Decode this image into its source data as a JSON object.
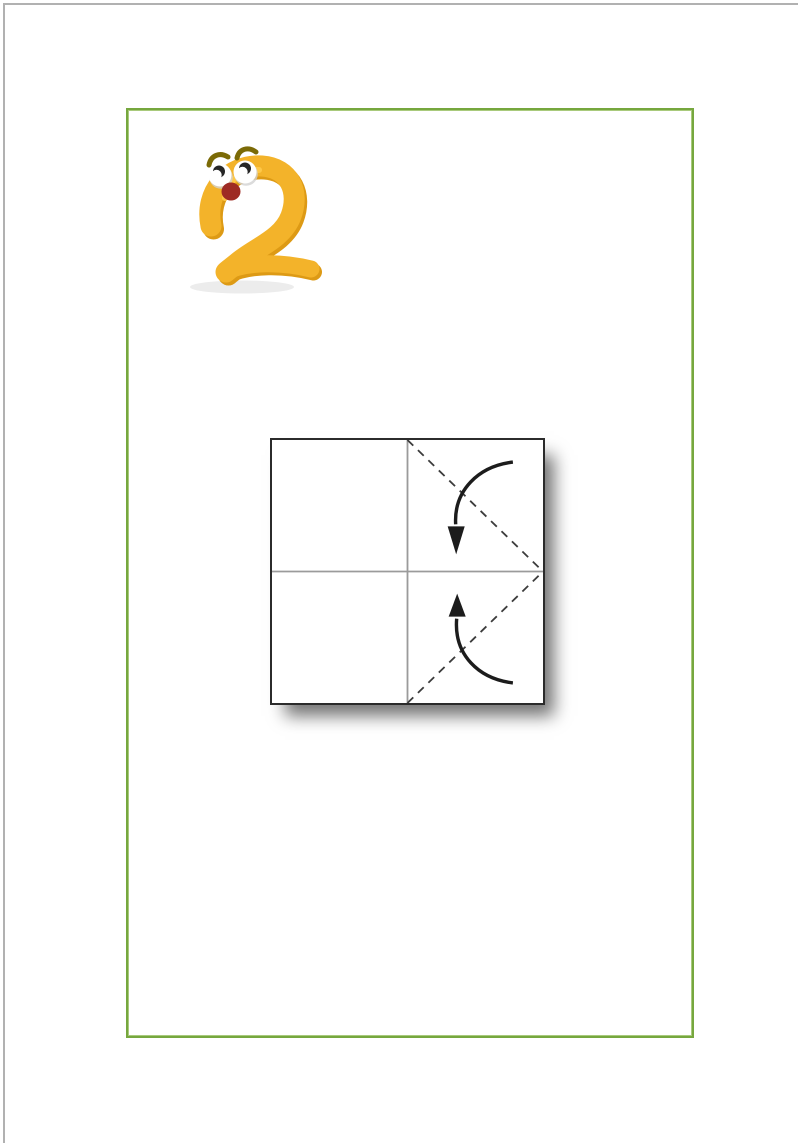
{
  "page": {
    "background": "#ffffff",
    "edge_border_color": "#b1b1b1",
    "frame_border_color": "#76a73e"
  },
  "figure_numeral": {
    "value": "2",
    "label": "Cartoon number two with worried face",
    "body_color": "#f3b32a",
    "shade_color": "#dd9a15",
    "highlight_color": "#ffcb4f",
    "eyebrow_color": "#7b6a06",
    "eye_color": "#ffffff",
    "eye_shadow_color": "#d2d2d2",
    "pupil_color": "#262626",
    "mouth_color": "#9e2b24",
    "ground_shadow_color": "#ececec"
  },
  "diagram": {
    "label": "Origami step: fold top-right and bottom-right corners along dashed lines toward the center crease",
    "paper_color": "#ffffff",
    "outline_color": "#2b2b2b",
    "crease_color": "#9b9b9b",
    "fold_line_color": "#3c3c3c",
    "arrow_color": "#1c1c1c"
  }
}
